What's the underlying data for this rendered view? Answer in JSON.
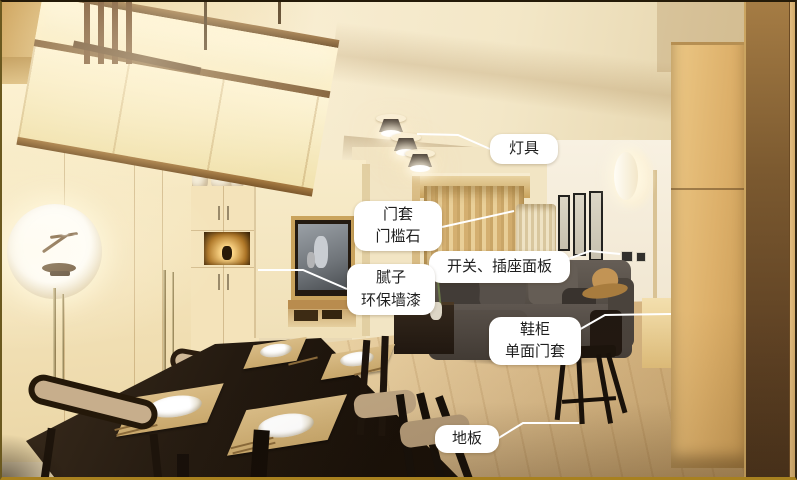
{
  "meta": {
    "description": "Annotated photo of a Japanese-style living and dining room; white callout labels mark renovation items"
  },
  "palette": {
    "label_background": "#ffffff",
    "label_text": "#1f1f1f",
    "leader_line": "#ffffff",
    "wall_cream": "#f2e3bd",
    "floor_wood": "#d8bd8d",
    "dining_table_wood": "#241a10",
    "sofa_grey": "#56504a",
    "oak_cabinet": "#ddb06a",
    "frame_border": "#6b591f"
  },
  "annotations": {
    "labels": [
      {
        "name": "lighting",
        "line1": "灯具",
        "line2": ""
      },
      {
        "name": "door-frame-threshold",
        "line1": "门套",
        "line2": "门槛石"
      },
      {
        "name": "switch-socket-panel",
        "line1": "开关、插座面板",
        "line2": ""
      },
      {
        "name": "putty-eco-paint",
        "line1": "腻子",
        "line2": "环保墙漆"
      },
      {
        "name": "shoe-cabinet-door-frame",
        "line1": "鞋柜",
        "line2": "单面门套"
      },
      {
        "name": "floor",
        "line1": "地板",
        "line2": ""
      }
    ]
  }
}
